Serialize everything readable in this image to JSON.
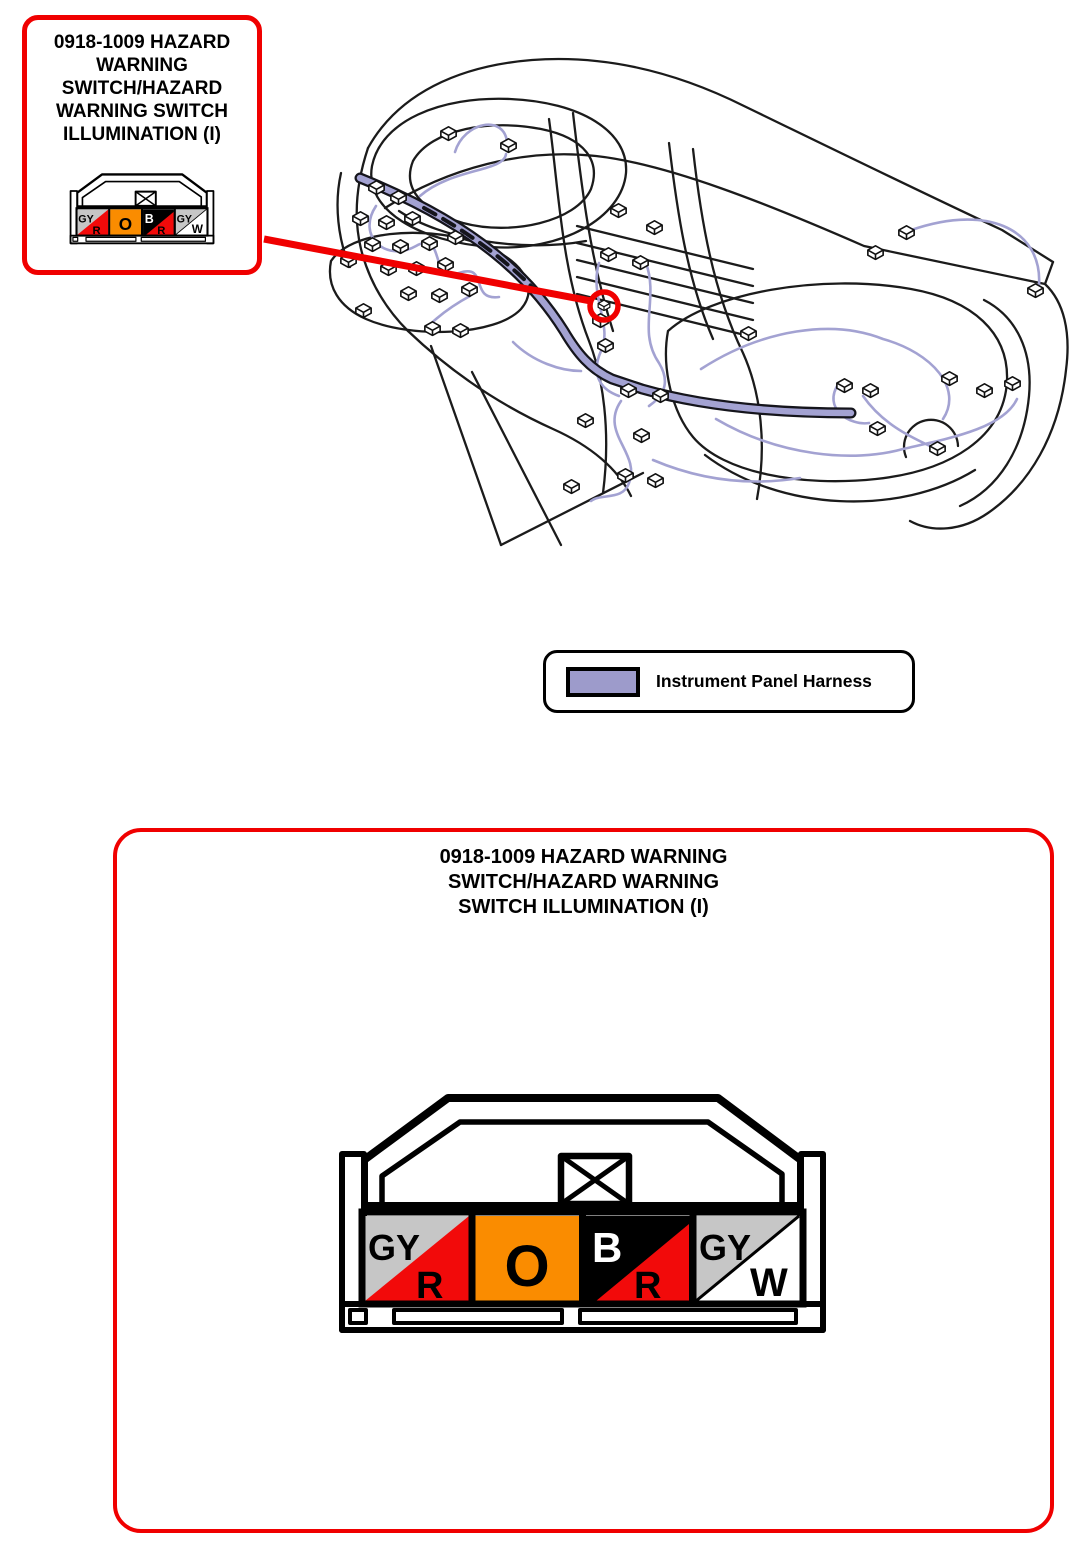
{
  "callout": {
    "title": "0918-1009 HAZARD\nWARNING\nSWITCH/HAZARD\nWARNING SWITCH\nILLUMINATION (I)"
  },
  "detail_panel": {
    "title": "0918-1009 HAZARD WARNING\nSWITCH/HAZARD WARNING\nSWITCH ILLUMINATION (I)"
  },
  "legend": {
    "label": "Instrument Panel Harness",
    "swatch_color": "#9D9BCB"
  },
  "connector": {
    "id": "0918-1009",
    "pins": [
      {
        "position": 1,
        "wire_color_code": "GY/R",
        "label_top": "GY",
        "label_bottom": "R",
        "color_top": "#C6C6C6",
        "color_bottom": "#F20A0A"
      },
      {
        "position": 2,
        "wire_color_code": "O",
        "label_top": "O",
        "label_bottom": "",
        "color_top": "#FA8C00",
        "color_bottom": "#FA8C00"
      },
      {
        "position": 3,
        "wire_color_code": "B/R",
        "label_top": "B",
        "label_bottom": "R",
        "color_top": "#000000",
        "color_bottom": "#F20A0A"
      },
      {
        "position": 4,
        "wire_color_code": "GY/W",
        "label_top": "GY",
        "label_bottom": "W",
        "color_top": "#C6C6C6",
        "color_bottom": "#FFFFFF"
      }
    ]
  },
  "diagram": {
    "marker_color": "#F00000",
    "harness_color": "#A3A2D2",
    "outline_color": "#1B1B1B"
  }
}
